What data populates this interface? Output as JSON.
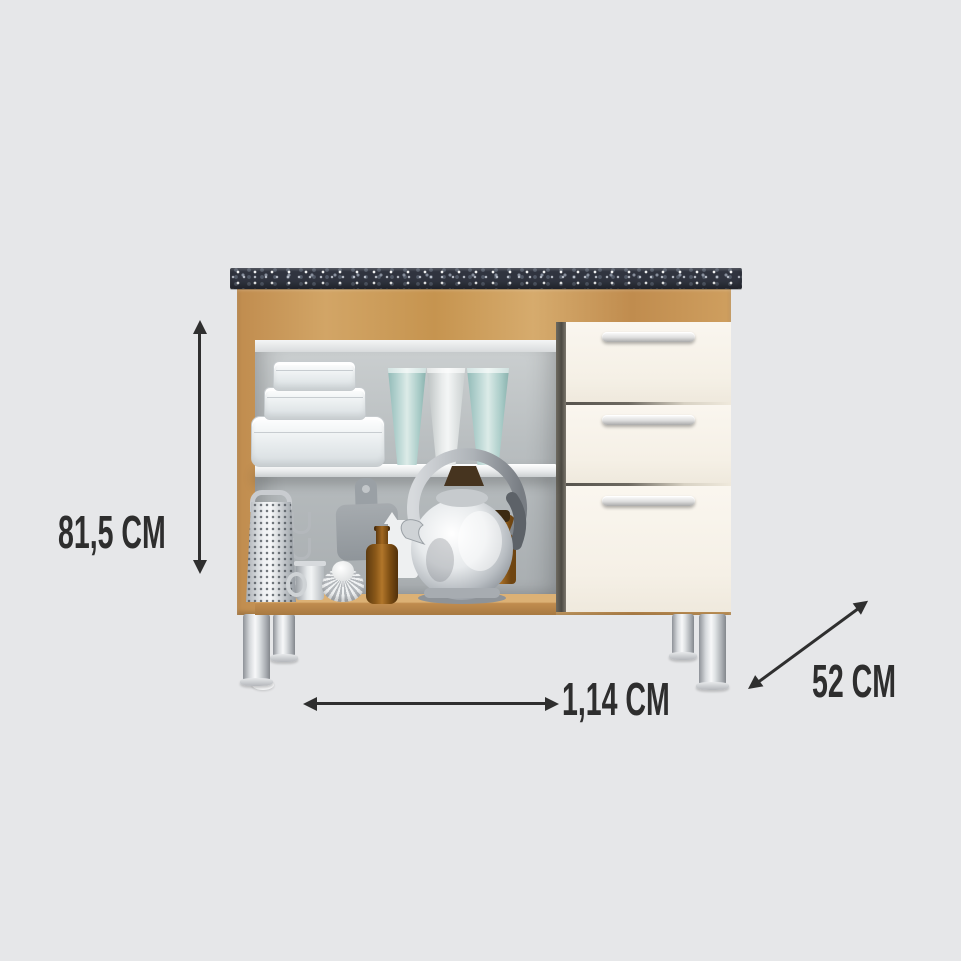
{
  "background_color": "#e6e7e9",
  "annotation_color": "#2e2e2e",
  "dimensions": {
    "height": {
      "label": "81,5 CM"
    },
    "width": {
      "label": "1,14 CM"
    },
    "depth": {
      "label": "52 CM"
    }
  },
  "cabinet": {
    "description": "kitchen base cabinet with speckled granite countertop, wood frame, two open shelf compartments and three cream drawer fronts on chrome legs",
    "drawer_count": 3,
    "leg_count": 4,
    "colors": {
      "countertop": "#30343f",
      "wood": "#c9985a",
      "interior": "#b3b8bb",
      "drawer_front": "#f7f2e9",
      "handle": "#d8d8d8",
      "leg_chrome": "#c6c9cd",
      "teal_cup": "#b5d3d1",
      "amber_glass": "#8a5819"
    },
    "shelf_items": {
      "top": [
        "stacked-food-containers",
        "teal-tumbler",
        "white-tumbler",
        "teal-tumbler"
      ],
      "bottom": [
        "box-grater",
        "hanging-hooks",
        "cutting-board",
        "silver-creamer",
        "fluted-tart-pan",
        "white-pitcher",
        "amber-bottle",
        "chrome-kettle",
        "amber-jar"
      ]
    }
  }
}
